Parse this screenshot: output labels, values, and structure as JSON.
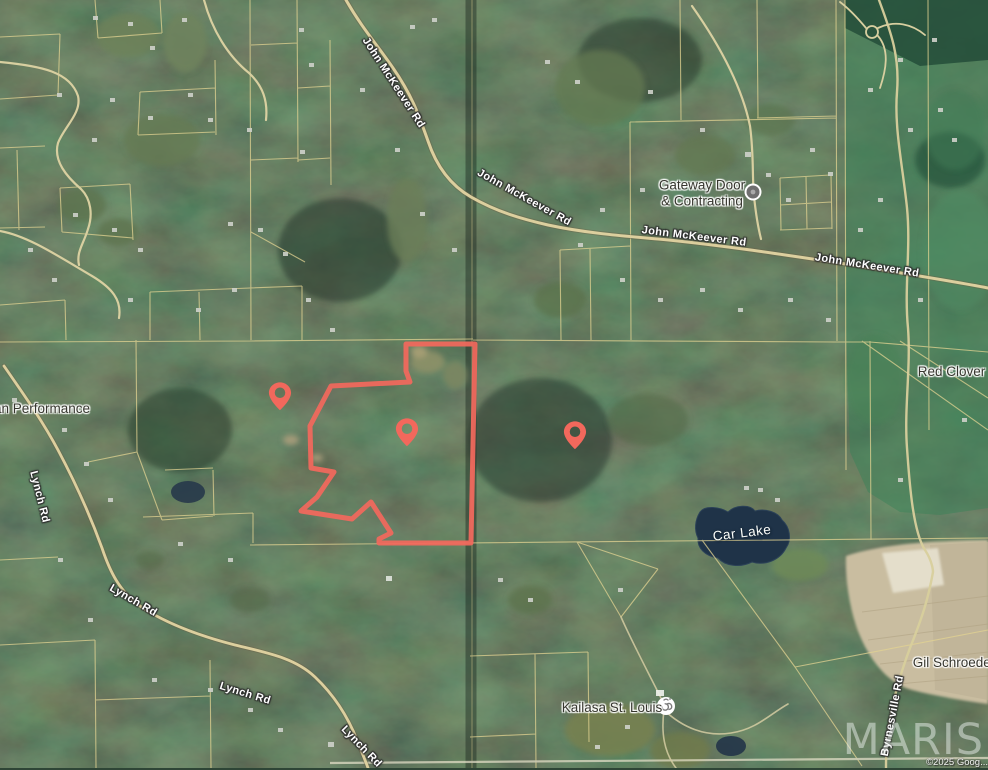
{
  "map": {
    "watermark": "MARIS",
    "attribution": "©2025 Goog...",
    "colors": {
      "boundary": "#f2685c",
      "pin": "#f2685c",
      "parcel_line": "#e2d392",
      "water": "#1f3348",
      "forest_base": "#2e4536"
    },
    "boundary": {
      "path": "M475,344 L406,344 L406,371 L410,382 L331,386 L310,426 L311,468 L334,472 L317,497 L301,511 L352,519 L371,502 L391,533 L379,539 L379,543 L471,543 Z"
    },
    "pins": [
      {
        "transform": "translate(263.8,380.3) scale(1.35)"
      },
      {
        "transform": "translate(390.8,416.3) scale(1.35)"
      },
      {
        "transform": "translate(558.8,419.3) scale(1.35)"
      }
    ],
    "road_labels": [
      {
        "text": "John McKeever Rd"
      },
      {
        "text": "John McKeever Rd"
      },
      {
        "text": "John McKeever Rd"
      },
      {
        "text": "John McKeever Rd"
      },
      {
        "text": "Lynch Rd"
      },
      {
        "text": "Lynch Rd"
      },
      {
        "text": "Lynch Rd"
      },
      {
        "text": "Lynch Rd"
      },
      {
        "text": "Byrnesville Rd"
      }
    ],
    "place_labels": {
      "performance": "an Performance",
      "gateway_line1": "Gateway Door",
      "gateway_line2": "& Contracting",
      "red_clover": "Red Clover Rd",
      "car_lake": "Car Lake",
      "kailasa": "Kailasa St. Louis",
      "gil_schroeder": "Gil Schroeder"
    }
  }
}
